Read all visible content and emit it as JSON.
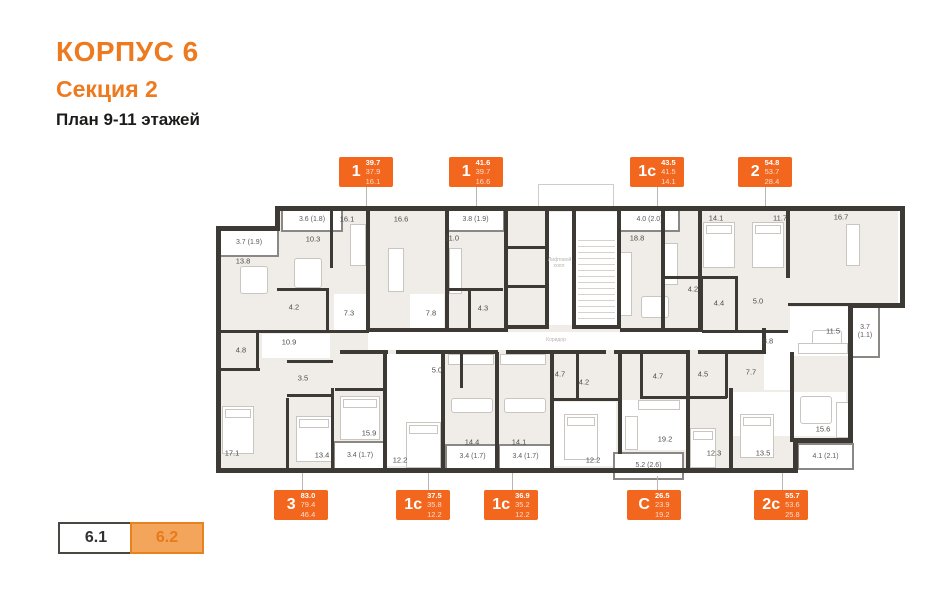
{
  "header": {
    "building": "КОРПУС 6",
    "section": "Секция 2",
    "plan": "План 9-11 этажей"
  },
  "colors": {
    "accent_orange": "#EE7A1F",
    "badge_orange": "#F2661E",
    "wall": "#3D3935",
    "room_fill": "#F0EDE9",
    "selector_active_fill": "#F2A55B",
    "selector_active_border": "#E8821F"
  },
  "apartments": {
    "top": [
      {
        "type": "1",
        "area_total": "39.7",
        "area_living": "37.9",
        "area_room": "16.1"
      },
      {
        "type": "1",
        "area_total": "41.6",
        "area_living": "39.7",
        "area_room": "16.6"
      },
      {
        "type": "1c",
        "area_total": "43.5",
        "area_living": "41.5",
        "area_room": "14.1"
      },
      {
        "type": "2",
        "area_total": "54.8",
        "area_living": "53.7",
        "area_room": "28.4"
      }
    ],
    "bottom": [
      {
        "type": "3",
        "area_total": "83.0",
        "area_living": "79.4",
        "area_room": "46.4"
      },
      {
        "type": "1c",
        "area_total": "37.5",
        "area_living": "35.8",
        "area_room": "12.2"
      },
      {
        "type": "1c",
        "area_total": "36.9",
        "area_living": "35.2",
        "area_room": "12.2"
      },
      {
        "type": "C",
        "area_total": "26.5",
        "area_living": "23.9",
        "area_room": "19.2"
      },
      {
        "type": "2c",
        "area_total": "55.7",
        "area_living": "53.6",
        "area_room": "25.8"
      }
    ]
  },
  "plan": {
    "room_labels": [
      "16.1",
      "10.3",
      "13.8",
      "4.2",
      "7.3",
      "16.6",
      "11.0",
      "4.3",
      "7.8",
      "18.8",
      "14.1",
      "11.7",
      "16.7",
      "4.2",
      "4.4",
      "5.0",
      "8.8",
      "11.5",
      "10.9",
      "4.8",
      "3.5",
      "17.1",
      "13.4",
      "15.9",
      "12.2",
      "5.0",
      "14.4",
      "14.1",
      "4.7",
      "4.2",
      "12.2",
      "4.7",
      "19.2",
      "4.5",
      "7.7",
      "12.3",
      "13.5",
      "15.6"
    ],
    "balcony_labels": [
      "3.6 (1.8)",
      "3.8 (1.9)",
      "4.0 (2.0)",
      "3.7 (1.9)",
      "3.7\n(1.1)",
      "3.4 (1.7)",
      "3.4 (1.7)",
      "3.4 (1.7)",
      "5.2 (2.6)",
      "4.1 (2.1)"
    ],
    "core_labels": {
      "lift": "Лифтовой холл",
      "corridor": "Коридор"
    }
  },
  "section_selector": {
    "items": [
      {
        "label": "6.1",
        "active": false
      },
      {
        "label": "6.2",
        "active": true
      }
    ]
  }
}
